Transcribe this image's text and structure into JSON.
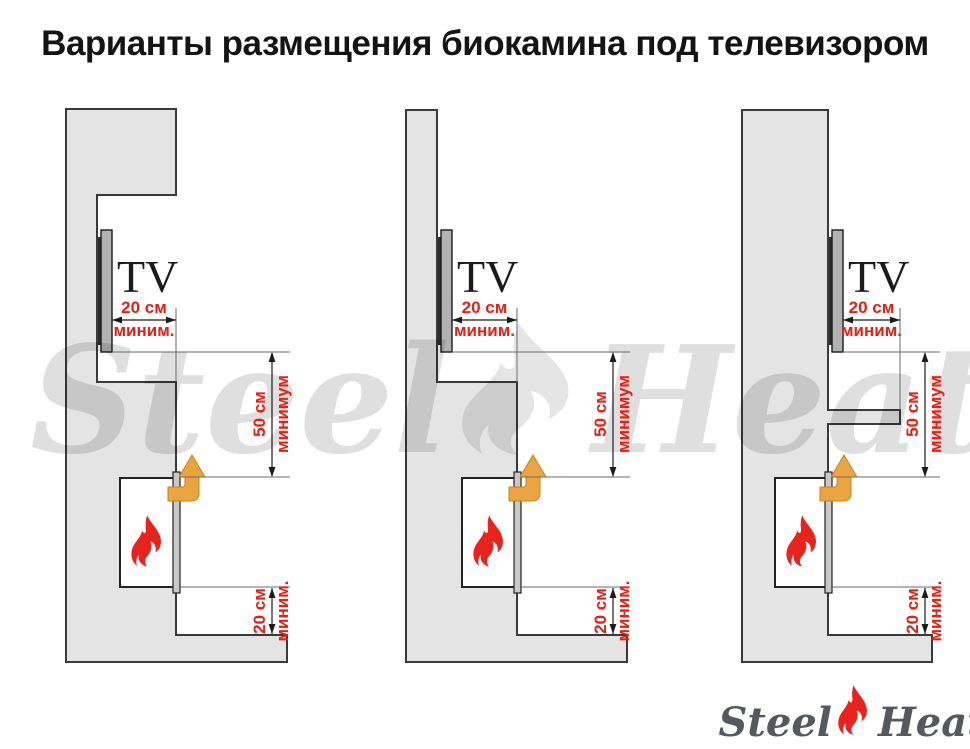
{
  "page": {
    "title": "Варианты размещения биокамина под телевизором"
  },
  "watermark": {
    "steel": "Steel",
    "heat": "Heat"
  },
  "logo": {
    "steel": "Steel",
    "heat": "Heat"
  },
  "colors": {
    "wall_fill": "#e4e4e4",
    "wall_outline": "#3a3a3a",
    "dimension_red": "#ea1d10",
    "flame_red": "#e8231d",
    "arrow_orange": "#eaa440",
    "arrow_outline": "#c5861c",
    "tv_gray": "#b2b2b2"
  },
  "diagrams": [
    {
      "tv_label": "TV",
      "dim_top": {
        "value": "20 см",
        "qualifier": "миним."
      },
      "dim_middle": {
        "value": "50 см",
        "qualifier": "минимум"
      },
      "dim_bottom": {
        "value": "20 см",
        "qualifier": "миним."
      }
    },
    {
      "tv_label": "TV",
      "dim_top": {
        "value": "20 см",
        "qualifier": "миним."
      },
      "dim_middle": {
        "value": "50 см",
        "qualifier": "минимум"
      },
      "dim_bottom": {
        "value": "20 см",
        "qualifier": "миним."
      }
    },
    {
      "tv_label": "TV",
      "dim_top": {
        "value": "20 см",
        "qualifier": "миним."
      },
      "dim_middle": {
        "value": "50 см",
        "qualifier": "минимум"
      },
      "dim_bottom": {
        "value": "20 см",
        "qualifier": "миним."
      }
    }
  ]
}
